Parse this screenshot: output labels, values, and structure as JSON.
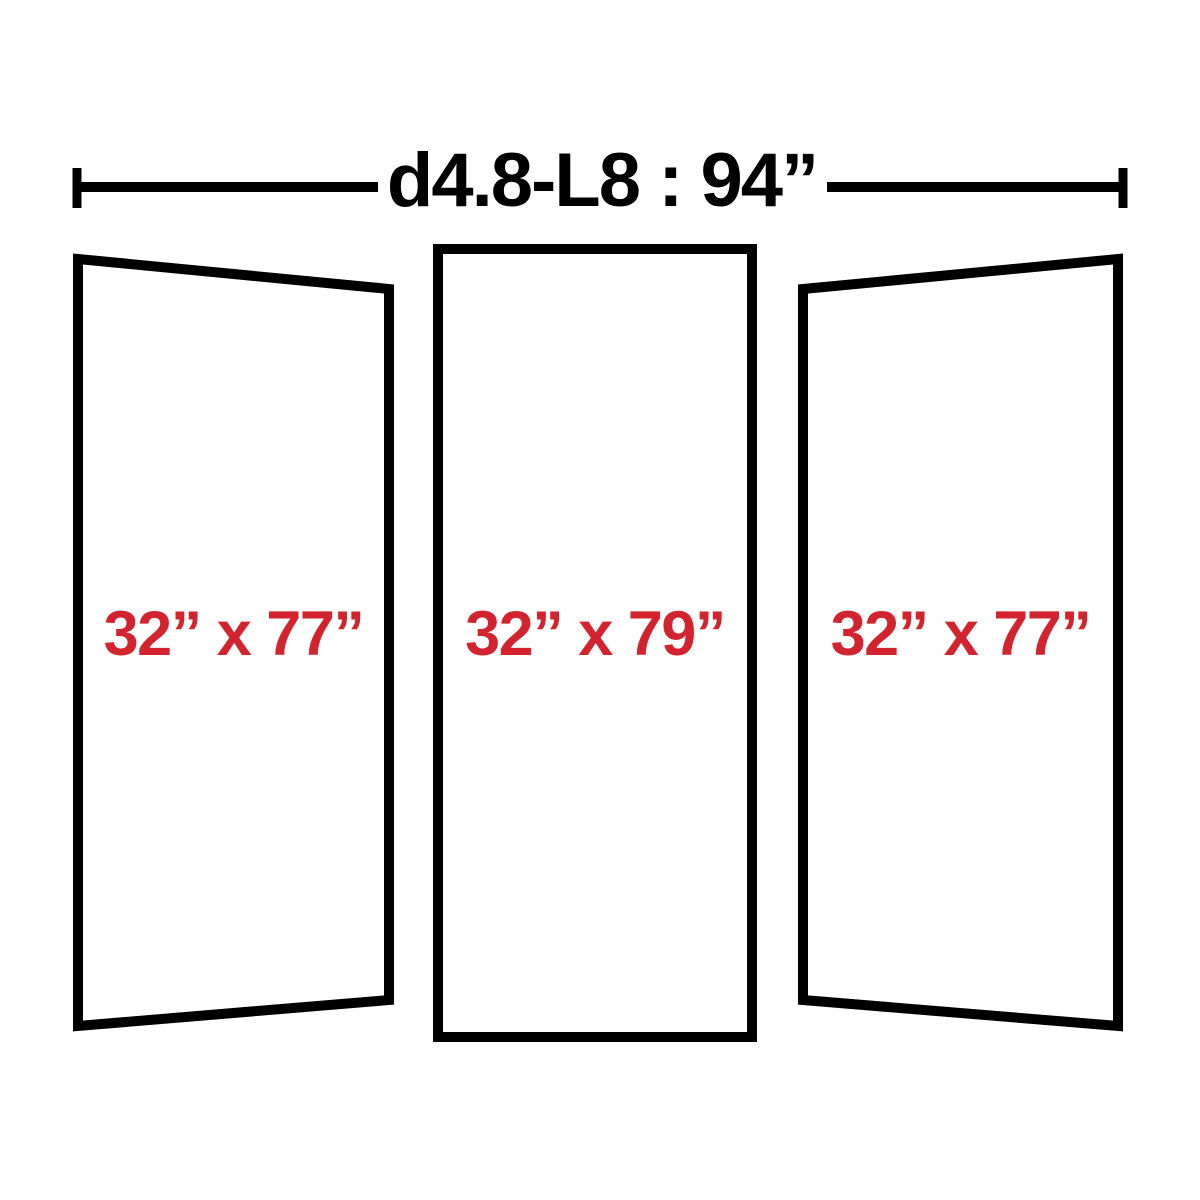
{
  "diagram": {
    "dimension_label": "d4.8-L8 : 94”",
    "panel_labels": [
      "32” x 77”",
      "32” x 79”",
      "32” x 77”"
    ],
    "colors": {
      "outline": "#000000",
      "size_label": "#d2232e",
      "background": "#ffffff"
    }
  }
}
